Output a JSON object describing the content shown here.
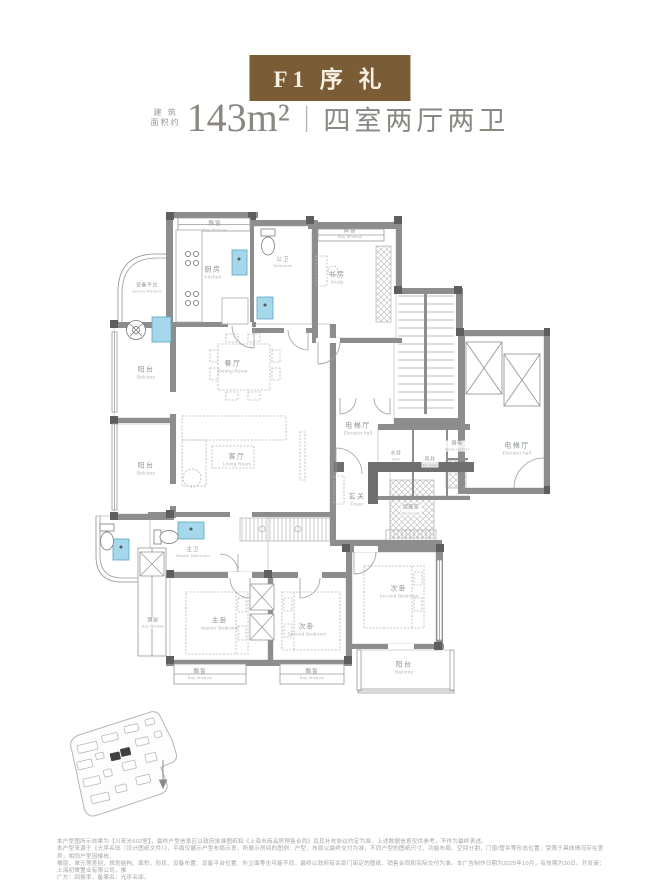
{
  "header": {
    "title": "F1 序 礼",
    "area_label_top": "建 筑",
    "area_label_bottom": "面积约",
    "area_value": "143m²",
    "divider": "|",
    "layout_text": "四室两厅两卫"
  },
  "colors": {
    "accent_brown": "#7a5c36",
    "header_text": "#8a8680",
    "wall_gray": "#8d8d8d",
    "heavy_wall_gray": "#6f6f6f",
    "fixture_blue": "#a5d8ea",
    "site_highlight": "#3f3f3f"
  },
  "icons": {
    "north_arrow": "↓",
    "washer": "⊛"
  },
  "floorplan": {
    "rooms": [
      {
        "id": "bay-window-kitchen",
        "cn": "飘窗",
        "en": "Bay Window"
      },
      {
        "id": "kitchen",
        "cn": "厨房",
        "en": "Kitchen"
      },
      {
        "id": "guest-bath",
        "cn": "公卫",
        "en": "Bathroom"
      },
      {
        "id": "bay-window-study",
        "cn": "飘窗",
        "en": "Bay Window"
      },
      {
        "id": "study",
        "cn": "书房",
        "en": "Study"
      },
      {
        "id": "service-platform",
        "cn": "设备平台",
        "en": "Service Platform"
      },
      {
        "id": "balcony-upper",
        "cn": "阳台",
        "en": "Balcony"
      },
      {
        "id": "dining-room",
        "cn": "餐厅",
        "en": "Dining Room"
      },
      {
        "id": "living-room",
        "cn": "客厅",
        "en": "Living Room"
      },
      {
        "id": "balcony-lower",
        "cn": "阳台",
        "en": "Balcony"
      },
      {
        "id": "elevator-hall-left",
        "cn": "电梯厅",
        "en": "Elevator hall"
      },
      {
        "id": "water-well",
        "cn": "水井",
        "en": "Well"
      },
      {
        "id": "air-shaft",
        "cn": "风井",
        "en": "Air shaft"
      },
      {
        "id": "weak-current",
        "cn": "弱电",
        "en": "Weak cabinet"
      },
      {
        "id": "elevator-hall-right",
        "cn": "电梯厅",
        "en": "Elevator hall"
      },
      {
        "id": "foyer",
        "cn": "玄关",
        "en": "Foyer"
      },
      {
        "id": "storeroom",
        "cn": "储藏室",
        "en": "Storeroom"
      },
      {
        "id": "master-bath",
        "cn": "主卫",
        "en": "Master Bathroom"
      },
      {
        "id": "master-bedroom",
        "cn": "主卧",
        "en": "Master Bedroom"
      },
      {
        "id": "second-bedroom-a",
        "cn": "次卧",
        "en": "Second Bedroom"
      },
      {
        "id": "second-bedroom-b",
        "cn": "次卧",
        "en": "Second Bedroom"
      },
      {
        "id": "bay-window-left",
        "cn": "飘窗",
        "en": "Bay Window"
      },
      {
        "id": "bay-window-master",
        "cn": "飘窗",
        "en": "Bay Window"
      },
      {
        "id": "bay-window-second",
        "cn": "飘窗",
        "en": "Bay Window"
      },
      {
        "id": "balcony-right",
        "cn": "阳台",
        "en": "Balcony"
      }
    ]
  },
  "disclaimer": {
    "lines": [
      "本户型图所示效果为【川来光602室】，最终户型信息应以政府批准图纸和《上海市商品房预售合同》及其补充协议约定为准，上述数据信息仅供参考，不作为最终表述。",
      "本户型来源于《光序名邸（设计图纸文件）》，平面仅展示户型布局示意，所展示房间的图例、户型、布局以最终交付为准，不同户型的图纸尺寸、功能布局、空间分割、门窗/管井等形态位置，受限于具体情况存在差异，相同户型因楼栋、",
      "楼层、单元等差别，规划结构、面积、形状、设备布置、设备平台位置、外立面等也可能不同，最终以政府有关部门审定的图纸、销售合同和实际交付为准。本广告制作日期为2025年10月，有效期为30日。开发商：上海初棠置业有限公司，推",
      "广方：回报率，备案名：光序名邸。"
    ]
  }
}
